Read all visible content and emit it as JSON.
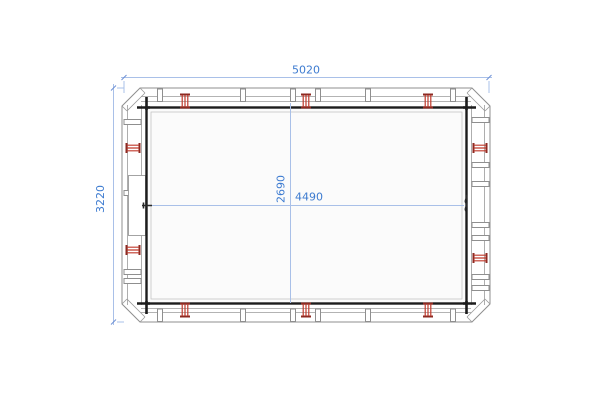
{
  "drawing": {
    "type": "cad-frame-plan",
    "dimension_labels": {
      "overall_width": "5020",
      "overall_height": "3220",
      "inner_width": "4490",
      "inner_height": "2690"
    },
    "colors": {
      "dimension_text": "#3d7bd0",
      "dimension_line": "#a9c0e8",
      "frame_dark": "#1c1c1c",
      "frame_gray": "#8f8f8f",
      "clamp_red": "#c0392b",
      "background": "#ffffff"
    }
  }
}
